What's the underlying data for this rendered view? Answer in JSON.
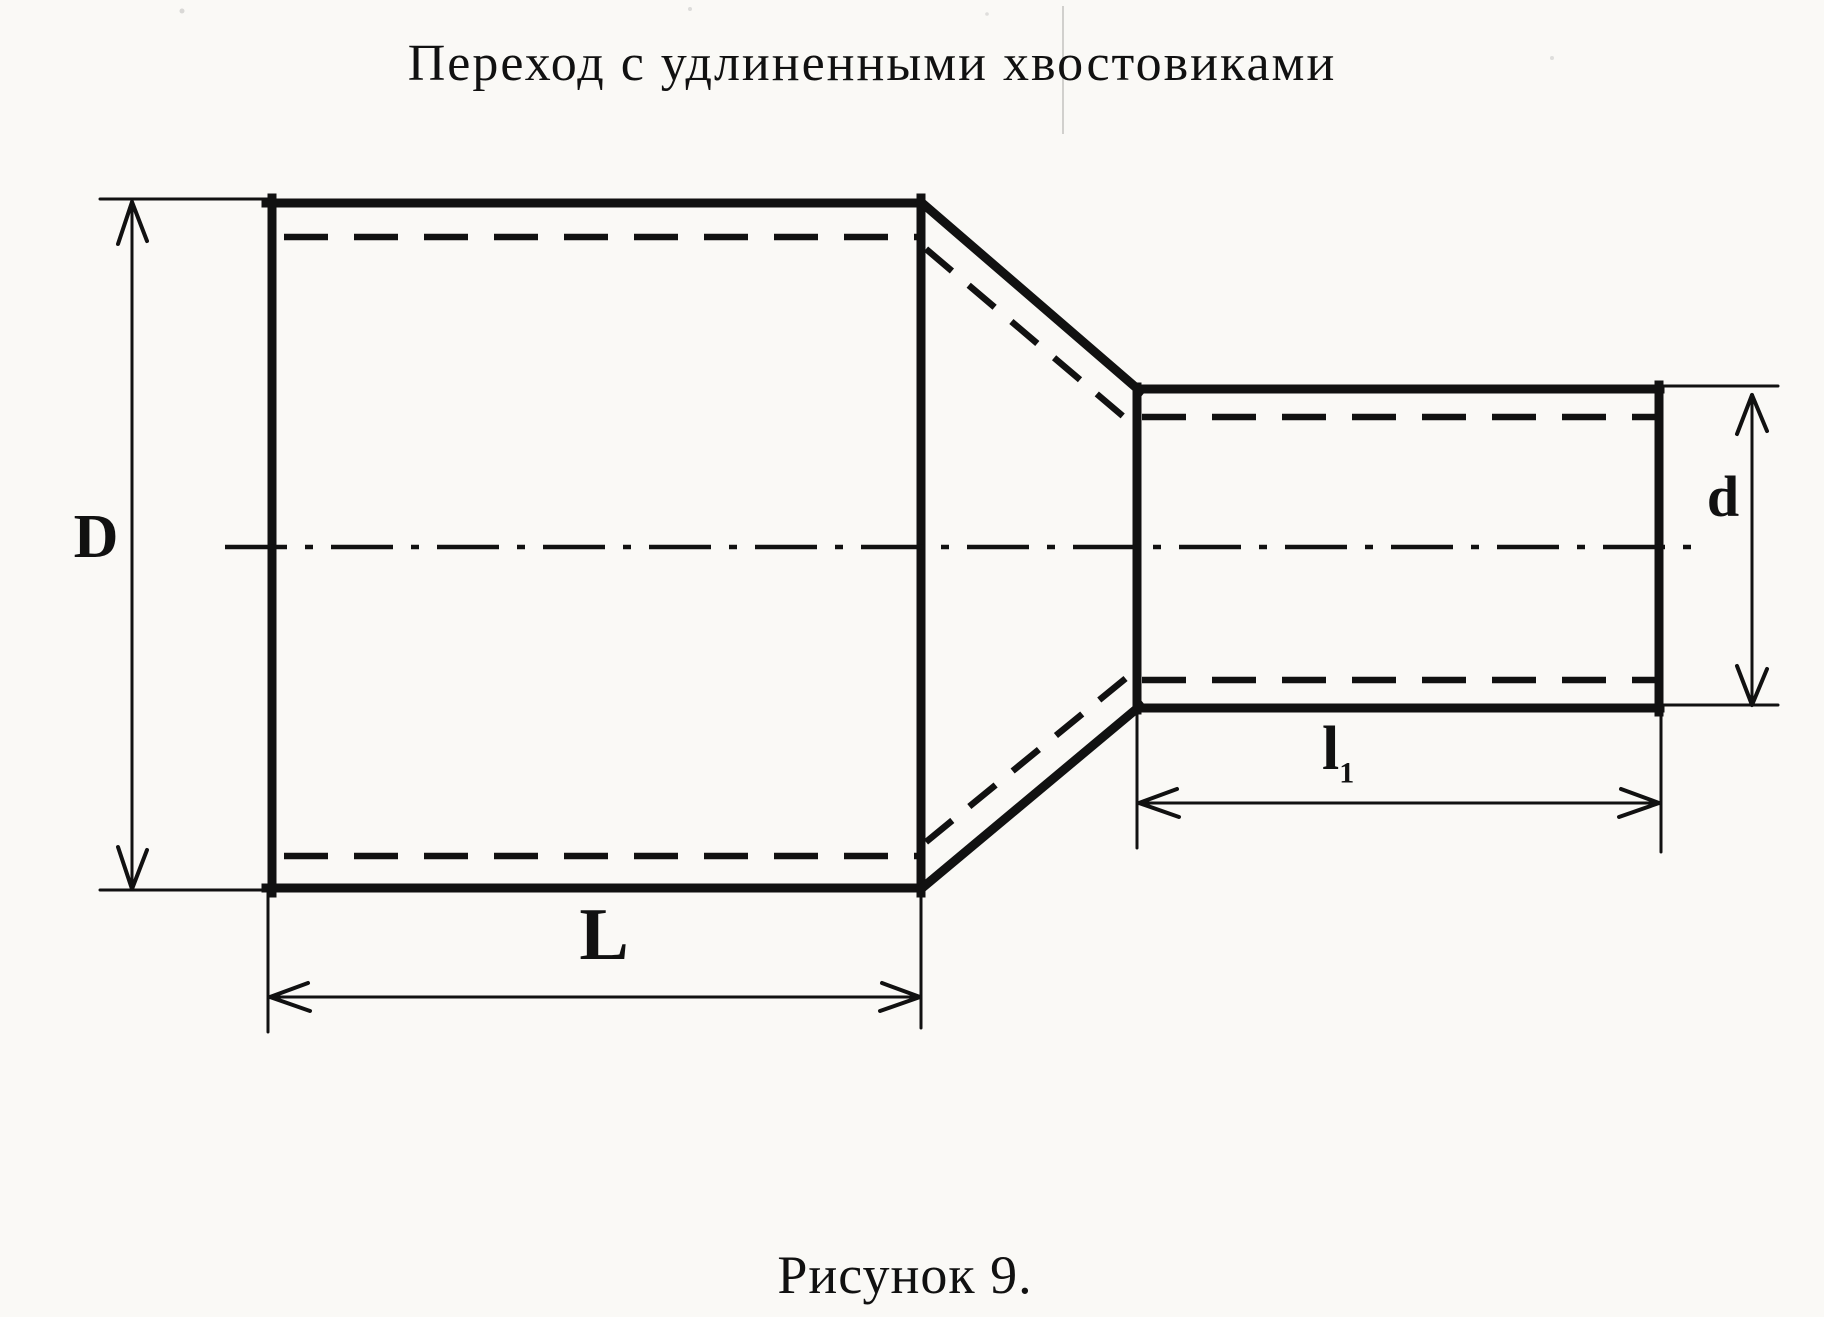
{
  "colors": {
    "ink": "#111111",
    "paper": "#faf9f6"
  },
  "title": "Переход с удлиненными хвостовиками",
  "caption": "Рисунок 9.",
  "labels": {
    "large_diameter": "D",
    "small_diameter": "d",
    "large_length": "L",
    "small_length_base": "l",
    "small_length_sub": "1"
  }
}
